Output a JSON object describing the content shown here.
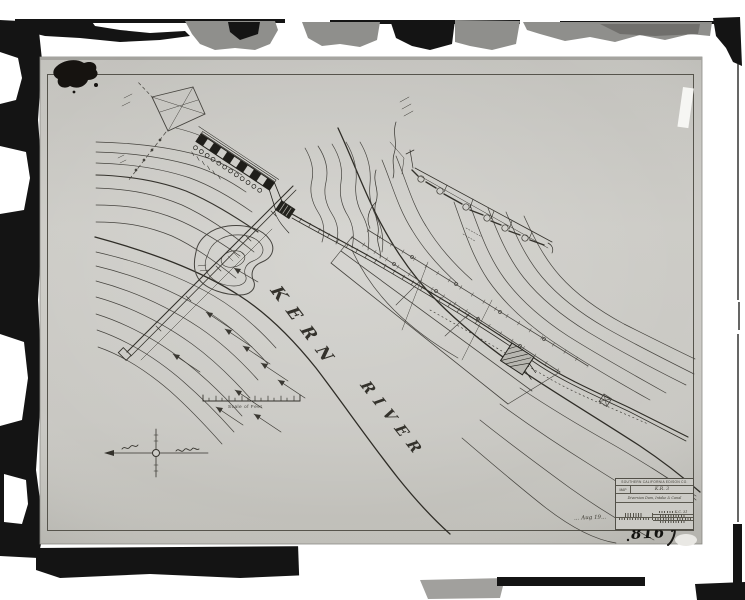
{
  "photo": {
    "catalog_number": "816",
    "handwritten_note": "… Aug 19…"
  },
  "map": {
    "river_name_word1": "KERN",
    "river_name_word2": "RIVER",
    "scale_caption": "Scale of Feet"
  },
  "title_block": {
    "company": "SOUTHERN CALIFORNIA EDISON CO.",
    "map_label": "MAP",
    "sheet_no": "K.R. 3",
    "drawing_title": "Diversion Dam, Intake & Canal",
    "drawing_no": "K.C. 31"
  },
  "colors": {
    "paper": "#cac9c4",
    "ink": "#35332e",
    "frame_black": "#141414"
  }
}
